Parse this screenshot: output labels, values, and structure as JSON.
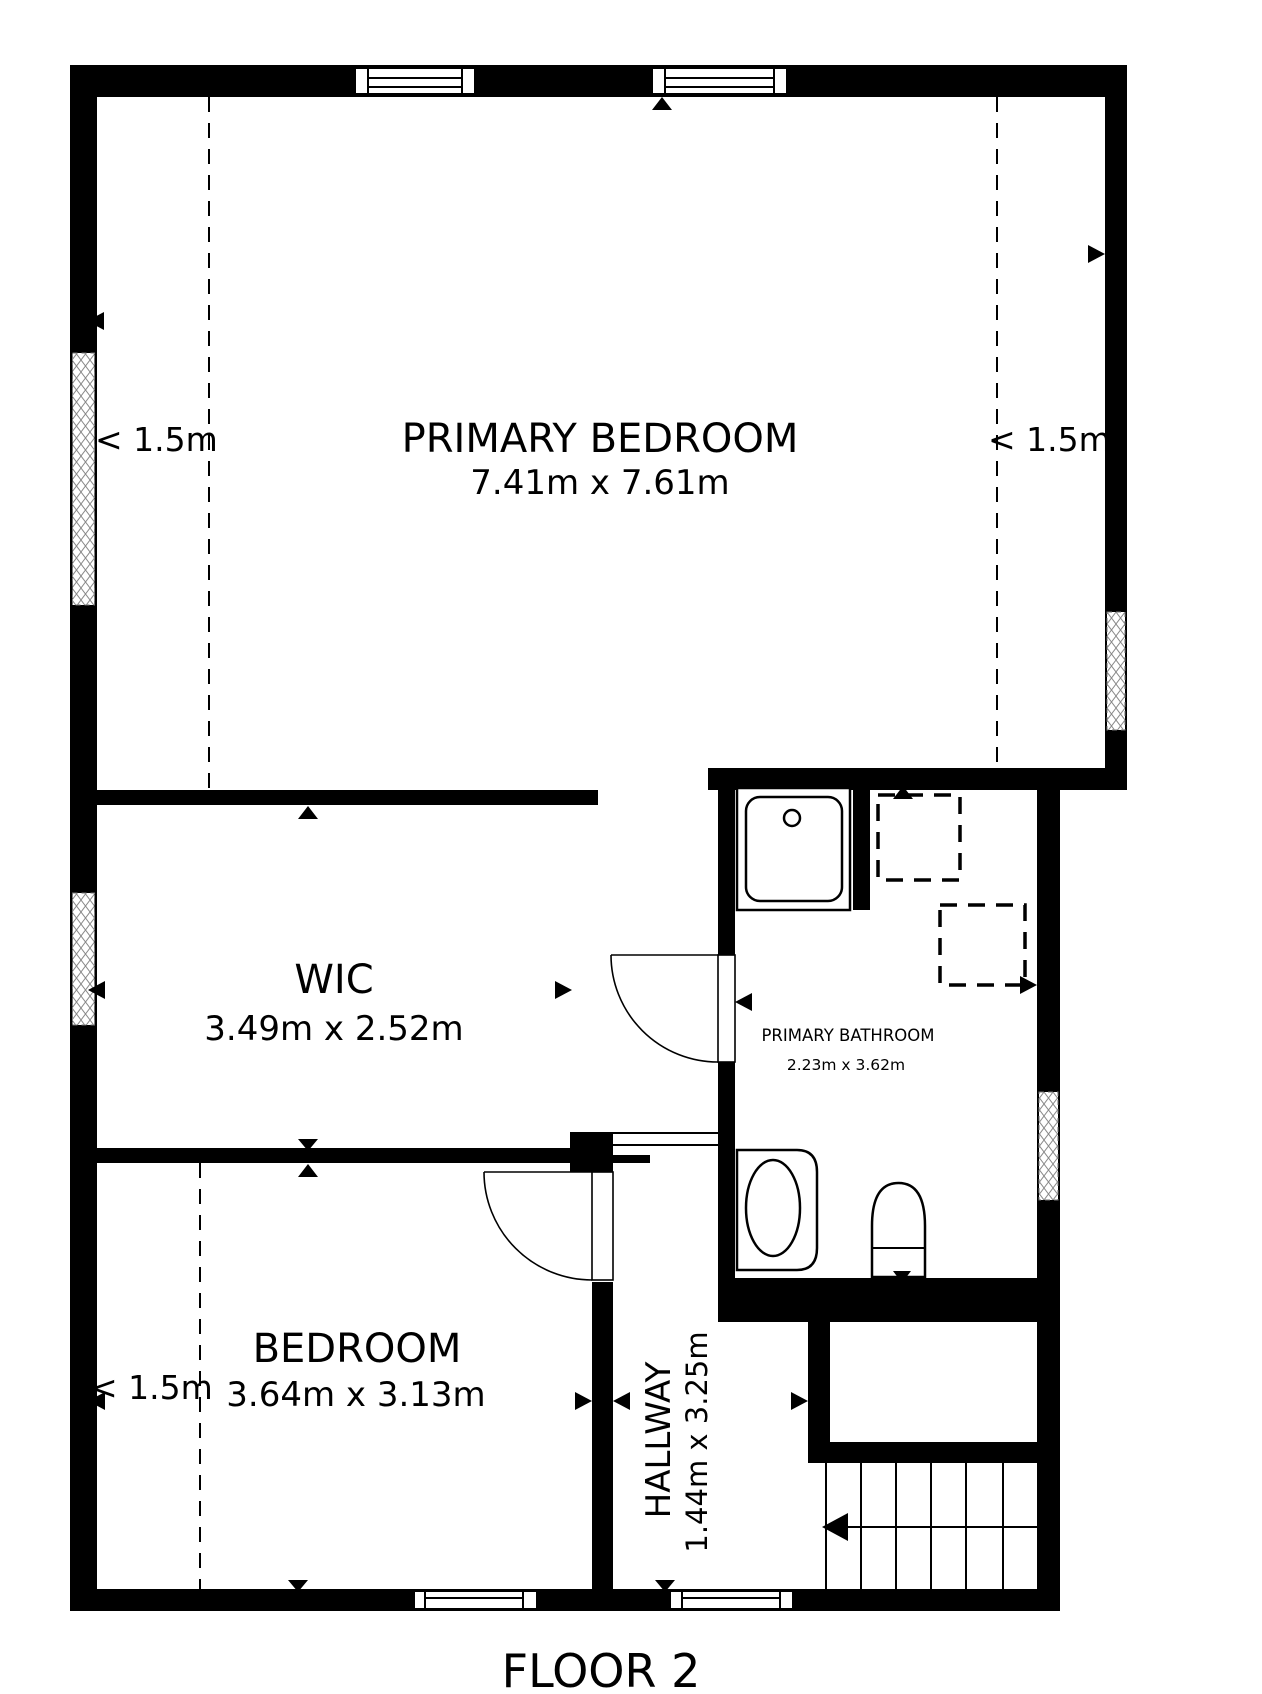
{
  "floor_plan": {
    "title": "FLOOR 2",
    "wall_color": "#000000",
    "background_color": "#ffffff",
    "text_color": "#000000",
    "rooms": {
      "primary_bedroom": {
        "name": "PRIMARY BEDROOM",
        "dims": "7.41m x 7.61m"
      },
      "wic": {
        "name": "WIC",
        "dims": "3.49m x 2.52m"
      },
      "primary_bathroom": {
        "name": "PRIMARY BATHROOM",
        "dims": "2.23m x 3.62m"
      },
      "bedroom": {
        "name": "BEDROOM",
        "dims": "3.64m x 3.13m"
      },
      "hallway": {
        "name": "HALLWAY",
        "dims": "1.44m x 3.25m"
      }
    },
    "ceiling_labels": {
      "primary_bedroom_left": "< 1.5m",
      "primary_bedroom_right": "< 1.5m",
      "bedroom": "< 1.5m"
    },
    "fixtures": [
      "shower",
      "sink",
      "toilet",
      "stairs"
    ]
  }
}
